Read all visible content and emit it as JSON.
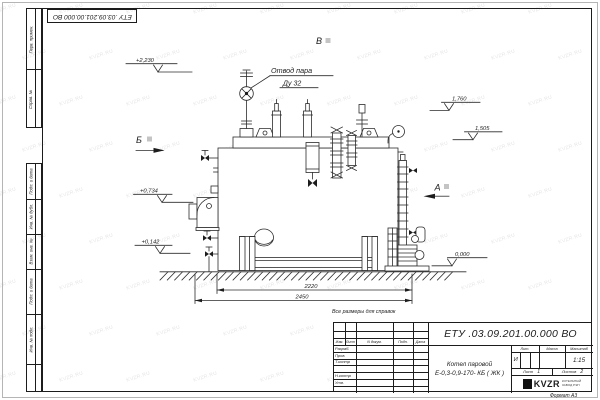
{
  "watermark": {
    "text": "KVZR.RU"
  },
  "stamps": {
    "top_doc_number": "ЕТУ .03.09.201.00.000  ВО"
  },
  "margin": {
    "upper": [
      "Перв. примен.",
      "Справ. №"
    ],
    "lower": [
      "Подп. и дата",
      "Инв. № дубл.",
      "Взам. инв. №",
      "Подп. и дата",
      "Инв. № подл."
    ]
  },
  "drawing": {
    "steam_outlet_label": "Отвод пара",
    "steam_outlet_size": "Ду 32",
    "view_top": "В",
    "view_left": "Б",
    "view_right": "А",
    "elev_steam": "+2,230",
    "elev_burner": "+0,734",
    "elev_drain": "+0,142",
    "elev_right_upper": "1,760",
    "elev_right_lower": "1,505",
    "elev_ground": "0,000",
    "dim_inner": "2220",
    "dim_outer": "2450",
    "ref_note": "Все размеры для справок"
  },
  "title_block": {
    "doc_number": "ЕТУ .03.09.201.00.000  ВО",
    "name_line1": "Котел паровой",
    "name_line2": "Е-0,3-0,9-170- КБ ( ЖК )",
    "header_cols": [
      "Изм.",
      "Лист",
      "N докум.",
      "Подп.",
      "Дата"
    ],
    "row_labels": [
      "Разраб.",
      "Пров.",
      "Т.контр",
      "",
      "Н.контр",
      "Утв."
    ],
    "lit_header": "Лит.",
    "mass_header": "Масса",
    "scale_header": "Масштаб",
    "lit_value": "И",
    "scale_value": "1:15",
    "sheet_label": "Лист",
    "sheet_value": "1",
    "sheets_label": "Листов",
    "sheets_value": "2",
    "logo_text": "KVZR",
    "company_line1": "КОТЕЛЬНЫЙ",
    "company_line2": "ЗАВОД РЭП",
    "format_label": "Формат А3"
  }
}
